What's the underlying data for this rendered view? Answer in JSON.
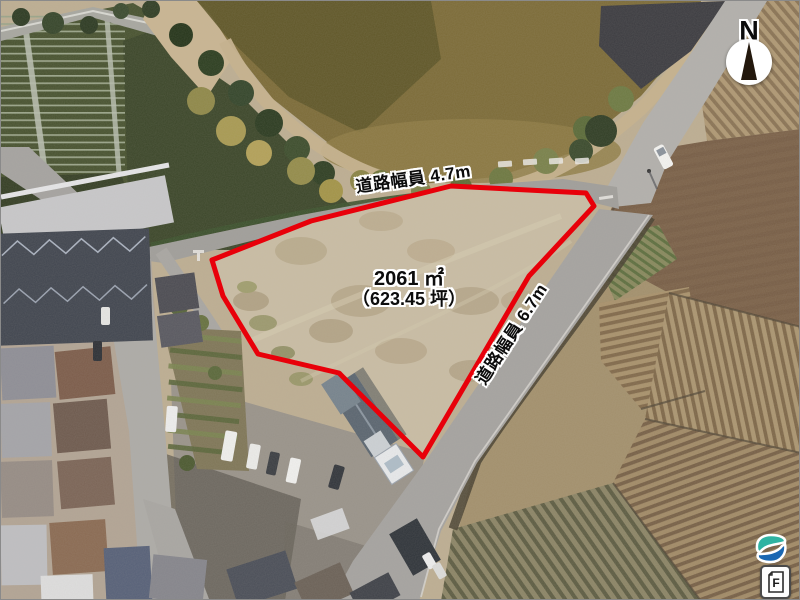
{
  "annotations": {
    "road_width_top": "道路幅員 4.7m",
    "area_sqm": "2061 ㎡",
    "area_tsubo": "（623.45 坪）",
    "road_width_right": "道路幅員 6.7m"
  },
  "compass": {
    "north_label": "N"
  },
  "badges": {
    "document_label": "F"
  },
  "colors": {
    "parcel_outline": "#e8000a",
    "logo_teal": "#2fb3a2",
    "logo_blue": "#1a67b2"
  }
}
